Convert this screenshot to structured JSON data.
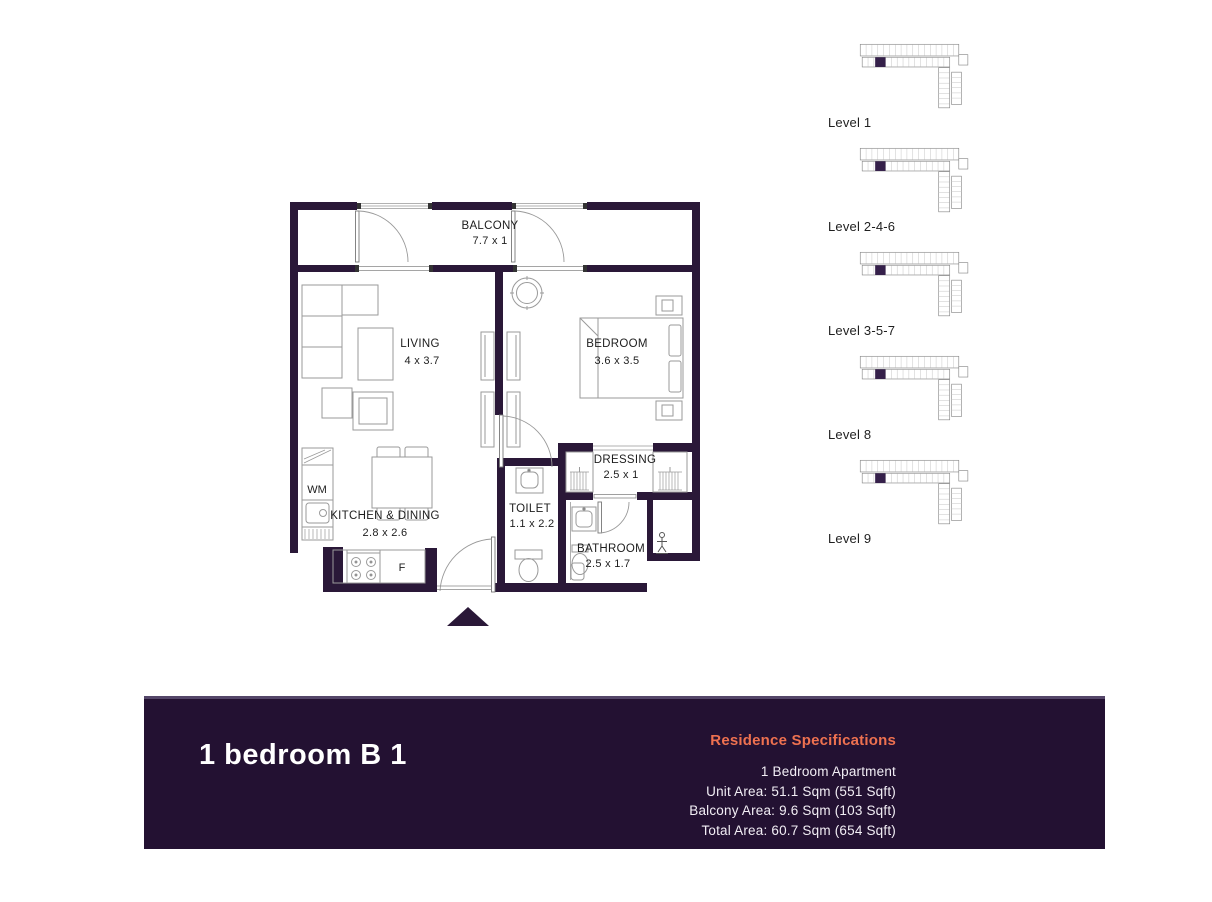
{
  "floor_plan": {
    "rooms": [
      {
        "name": "BALCONY",
        "dims": "7.7 x 1"
      },
      {
        "name": "LIVING",
        "dims": "4 x 3.7"
      },
      {
        "name": "BEDROOM",
        "dims": "3.6 x 3.5"
      },
      {
        "name": "DRESSING",
        "dims": "2.5 x 1"
      },
      {
        "name": "TOILET",
        "dims": "1.1 x 2.2"
      },
      {
        "name": "KITCHEN & DINING",
        "dims": "2.8 x 2.6"
      },
      {
        "name": "BATHROOM",
        "dims": "2.5 x 1.7"
      }
    ],
    "appliances": {
      "washer": "WM",
      "fridge": "F"
    }
  },
  "levels": [
    {
      "label": "Level 1"
    },
    {
      "label": "Level 2-4-6"
    },
    {
      "label": "Level 3-5-7"
    },
    {
      "label": "Level 8"
    },
    {
      "label": "Level 9"
    }
  ],
  "banner": {
    "title": "1 bedroom B 1",
    "specs_heading": "Residence Specifications",
    "specs_lines": [
      "1 Bedroom Apartment",
      "Unit Area: 51.1 Sqm (551 Sqft)",
      "Balcony Area: 9.6 Sqm (103 Sqft)",
      "Total Area: 60.7 Sqm (654 Sqft)"
    ]
  },
  "colors": {
    "wall": "#2a1838",
    "banner_bg": "#231132",
    "accent_orange": "#ee7150",
    "plan_line_gray": "#9a9a9a",
    "highlight_unit": "#35204a"
  }
}
